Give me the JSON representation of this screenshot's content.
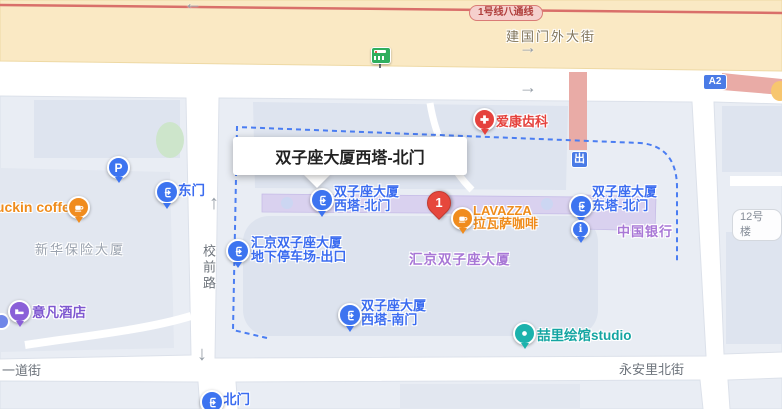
{
  "badges": {
    "subway_line": "1号线八通线",
    "a2": "A2",
    "exit": "出",
    "building12": "12号楼"
  },
  "streets": {
    "jianguomenwai": "建国门外大街",
    "xiaoqianlu": "校前路",
    "yidaojie": "一道街",
    "yonganli": "永安里北街"
  },
  "buildings": {
    "xinhua": "新华保险大厦",
    "huijing": "汇京双子座大厦",
    "boc": "中国银行"
  },
  "infobox": {
    "title": "双子座大厦西塔-北门"
  },
  "marker": {
    "number": "1"
  },
  "entrances": {
    "east_gate": "东门",
    "north_gate": "北门",
    "west_tower_north": {
      "line1": "双子座大厦",
      "line2": "西塔-北门"
    },
    "east_tower_north": {
      "line1": "双子座大厦",
      "line2": "东塔-北门"
    },
    "west_tower_south": {
      "line1": "双子座大厦",
      "line2": "西塔-南门"
    },
    "parking_exit": {
      "line1": "汇京双子座大厦",
      "line2": "地下停车场-出口"
    }
  },
  "pois": {
    "aikang_dental": "爱康齿科",
    "lavazza": {
      "line1": "LAVAZZA",
      "line2": "拉瓦萨咖啡"
    },
    "luckin": "luckin coffee",
    "yifan_hotel": "意凡酒店",
    "zheli_studio": "喆里绘馆studio",
    "parking_p": "P"
  },
  "arrows": {
    "left": "←",
    "right": "→",
    "up": "↑",
    "down": "↓"
  },
  "colors": {
    "road_yellow": "#FAE9C4",
    "subway_line_red": "#D96F6A",
    "entrance_blue": "#3D74F0",
    "label_blue": "#3B6CF0",
    "area_purple": "#A877D6",
    "building_purple": "#D9D1EF",
    "poi_orange": "#F08C1E",
    "poi_red": "#E5423D",
    "poi_teal": "#1BB2AC",
    "poi_hotel_purple": "#8A5FD8",
    "marker_red": "#E6473C",
    "selection_dash_blue": "#4A7DF2",
    "overpass_pink": "#E9ABA6"
  }
}
